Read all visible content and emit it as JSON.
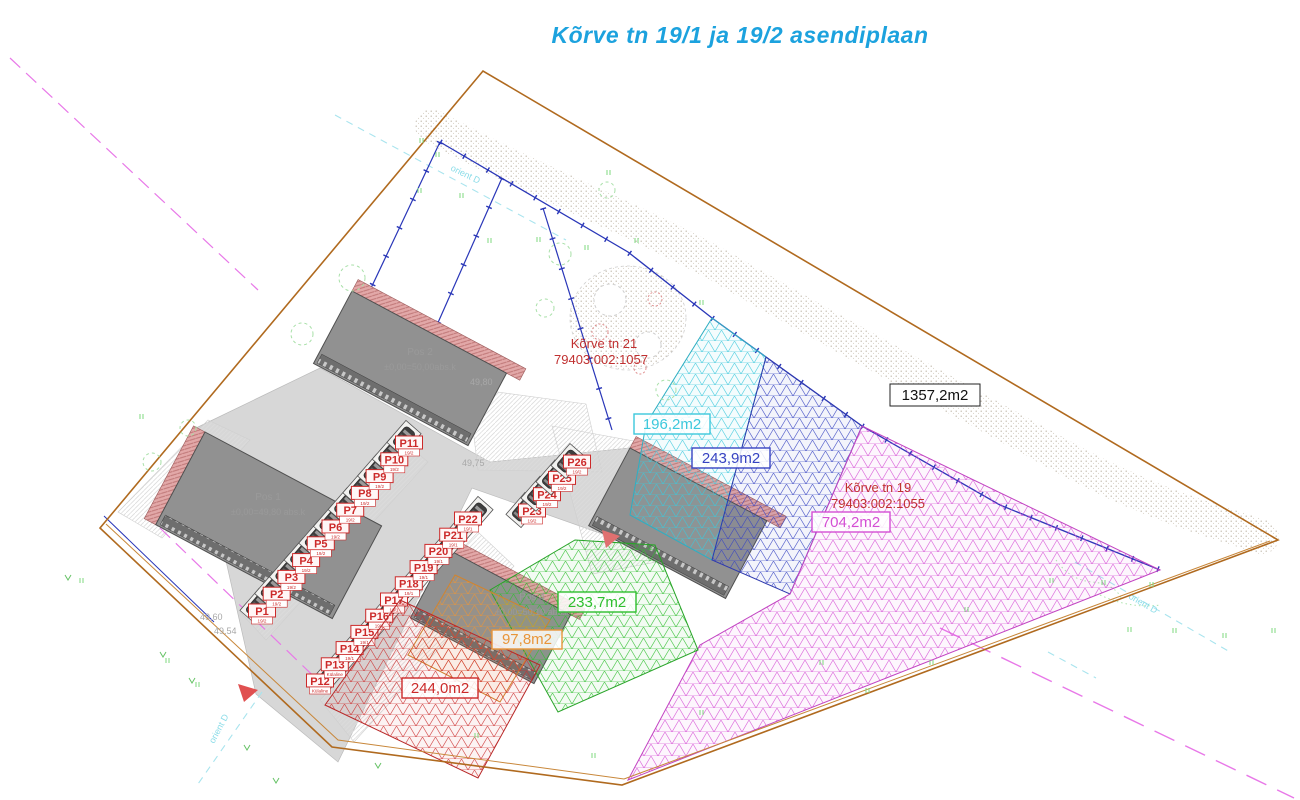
{
  "title": {
    "text": "Kõrve tn 19/1 ja 19/2 asendiplaan",
    "color": "#1CA2DE"
  },
  "parcels": {
    "korve21": {
      "name": "Kõrve tn 21",
      "cadastral": "79403:002:1057"
    },
    "korve19": {
      "name": "Kõrve tn 19",
      "cadastral": "79403:002:1055"
    },
    "boundary_area_label": "1357,2m2"
  },
  "zones": {
    "cyan": {
      "area": "196,2m2",
      "color": "#3CC8DC"
    },
    "blue": {
      "area": "243,9m2",
      "color": "#3744C2"
    },
    "magenta": {
      "area": "704,2m2",
      "color": "#D44FD4"
    },
    "green": {
      "area": "233,7m2",
      "color": "#2EBE2E"
    },
    "orange": {
      "area": "97,8m2",
      "color": "#E8953A"
    },
    "red": {
      "area": "244,0m2",
      "color": "#CC2F2F"
    }
  },
  "buildings": {
    "pos1": {
      "label": "Pos 1",
      "elevation": "±0,00=49,80 abs.k"
    },
    "pos2": {
      "label": "Pos 2",
      "elevation": "±0,00=50,00abs.k"
    },
    "pos4": {
      "label": "Pos 4",
      "elevation": "±0,00=50,10 abs.k"
    }
  },
  "parking": {
    "stalls": [
      {
        "label": "P1",
        "sub": "19/2"
      },
      {
        "label": "P2",
        "sub": "19/2"
      },
      {
        "label": "P3",
        "sub": "19/2"
      },
      {
        "label": "P4",
        "sub": "19/2"
      },
      {
        "label": "P5",
        "sub": "19/2"
      },
      {
        "label": "P6",
        "sub": "19/2"
      },
      {
        "label": "P7",
        "sub": "19/2"
      },
      {
        "label": "P8",
        "sub": "19/2"
      },
      {
        "label": "P9",
        "sub": "19/2"
      },
      {
        "label": "P10",
        "sub": "19/2"
      },
      {
        "label": "P11",
        "sub": "19/2"
      },
      {
        "label": "P12",
        "sub": "Külaline"
      },
      {
        "label": "P13",
        "sub": "Külaline"
      },
      {
        "label": "P14",
        "sub": "19/1"
      },
      {
        "label": "P15",
        "sub": "19/1"
      },
      {
        "label": "P16",
        "sub": "19/1"
      },
      {
        "label": "P17",
        "sub": "19/1"
      },
      {
        "label": "P18",
        "sub": "19/1"
      },
      {
        "label": "P19",
        "sub": "19/1"
      },
      {
        "label": "P20",
        "sub": "19/1"
      },
      {
        "label": "P21",
        "sub": "19/1"
      },
      {
        "label": "P22",
        "sub": "19/1"
      },
      {
        "label": "P23",
        "sub": "19/2"
      },
      {
        "label": "P24",
        "sub": "19/2"
      },
      {
        "label": "P25",
        "sub": "19/2"
      },
      {
        "label": "P26",
        "sub": "19/2"
      }
    ]
  },
  "annotations": {
    "orient": "orient D",
    "elevations": [
      "49,80",
      "49,75",
      "49,60",
      "49,54"
    ]
  }
}
